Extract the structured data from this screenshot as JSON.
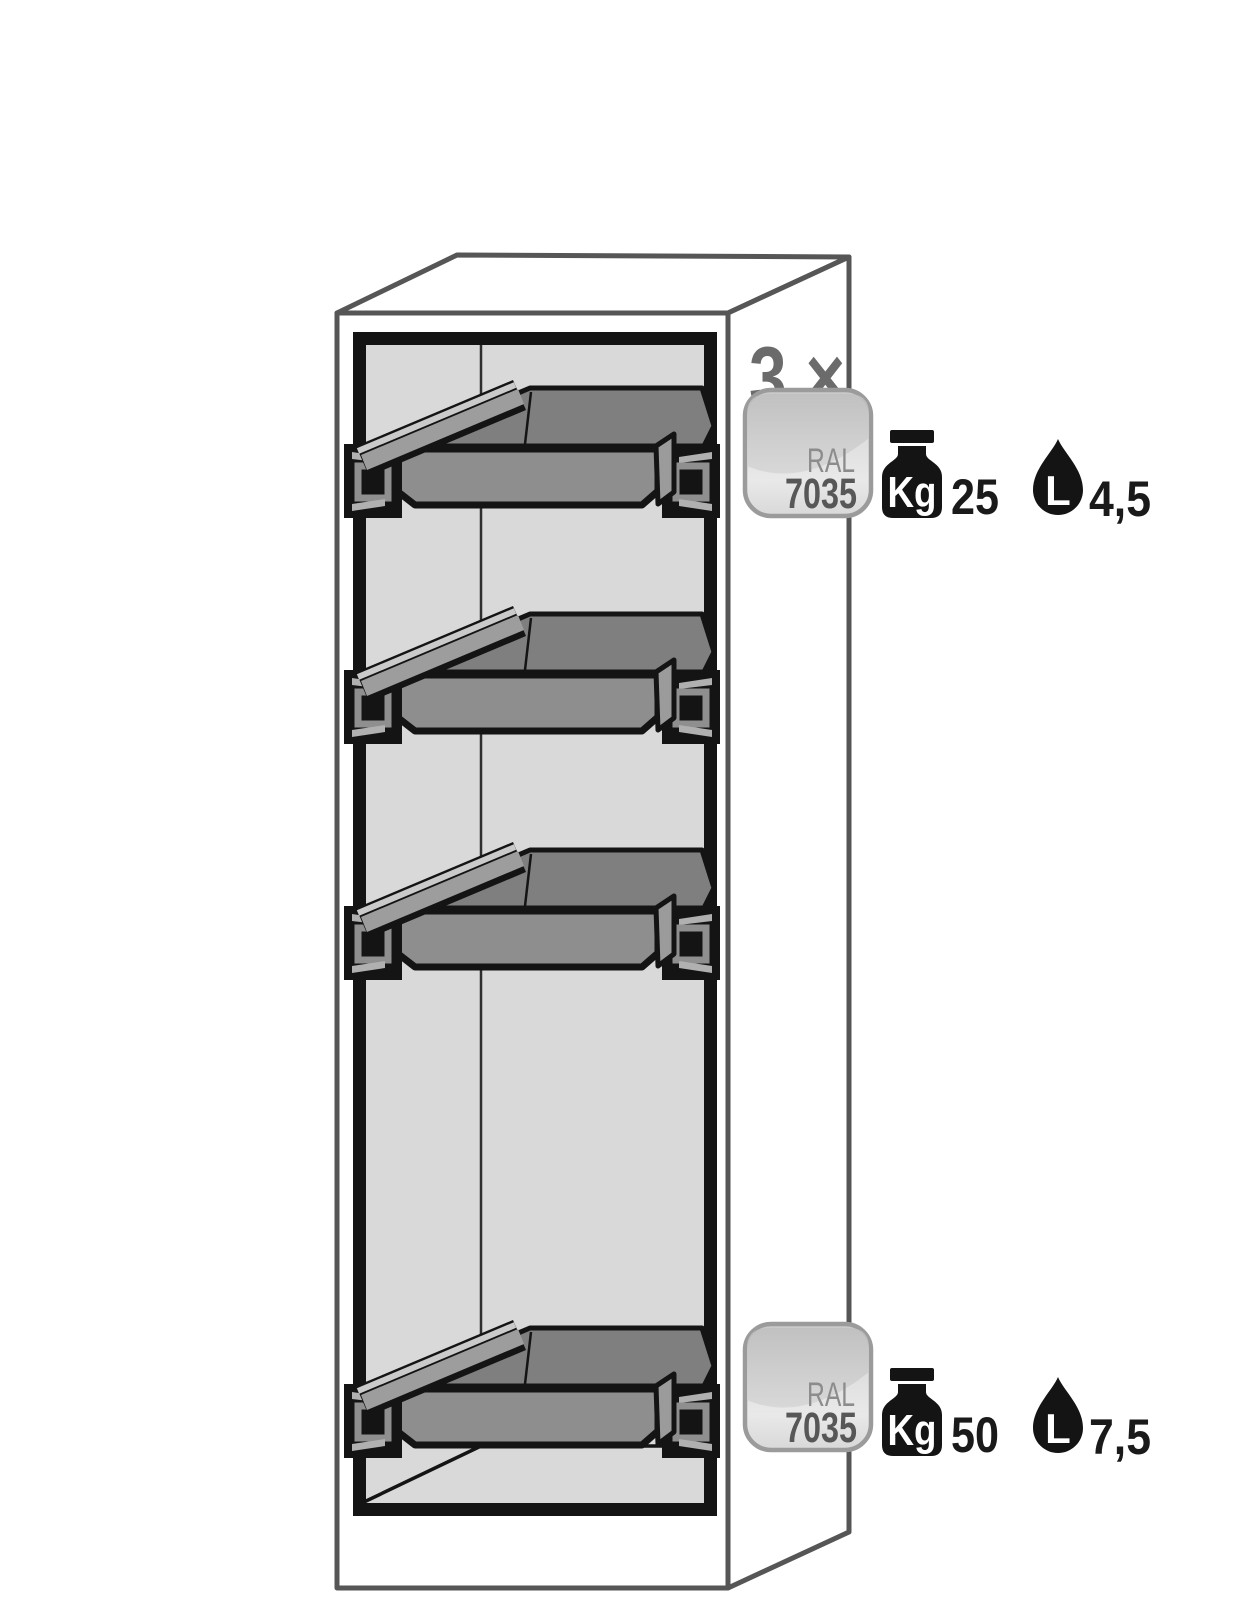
{
  "figure": {
    "type": "product-technical-illustration",
    "description": "Tall safety cabinet shown in perspective with four pull-out spill trays",
    "tray_count": 4
  },
  "annotations": {
    "top": {
      "multiplier": "3 ×",
      "weight_value": "25",
      "volume_value": "4,5"
    },
    "bottom": {
      "weight_value": "50",
      "volume_value": "7,5"
    },
    "ral_badge": {
      "line1": "RAL",
      "line2": "7035"
    },
    "weight_unit_label": "Kg",
    "volume_unit_label": "L"
  },
  "colors": {
    "outline_gray": "#565656",
    "multiplier_gray": "#6b6b6b",
    "ral_line1_gray": "#8c8c8c",
    "ral_line2_gray": "#575757",
    "badge_border": "#9b9b9b",
    "icon_black": "#141414",
    "value_black": "#1a1a1a",
    "interior_gray": "#d9d9d9",
    "tray_top_gray": "#7f7f7f",
    "tray_front_gray": "#8e8e8e",
    "tray_band_gray": "#9d9d9d",
    "white": "#ffffff"
  }
}
